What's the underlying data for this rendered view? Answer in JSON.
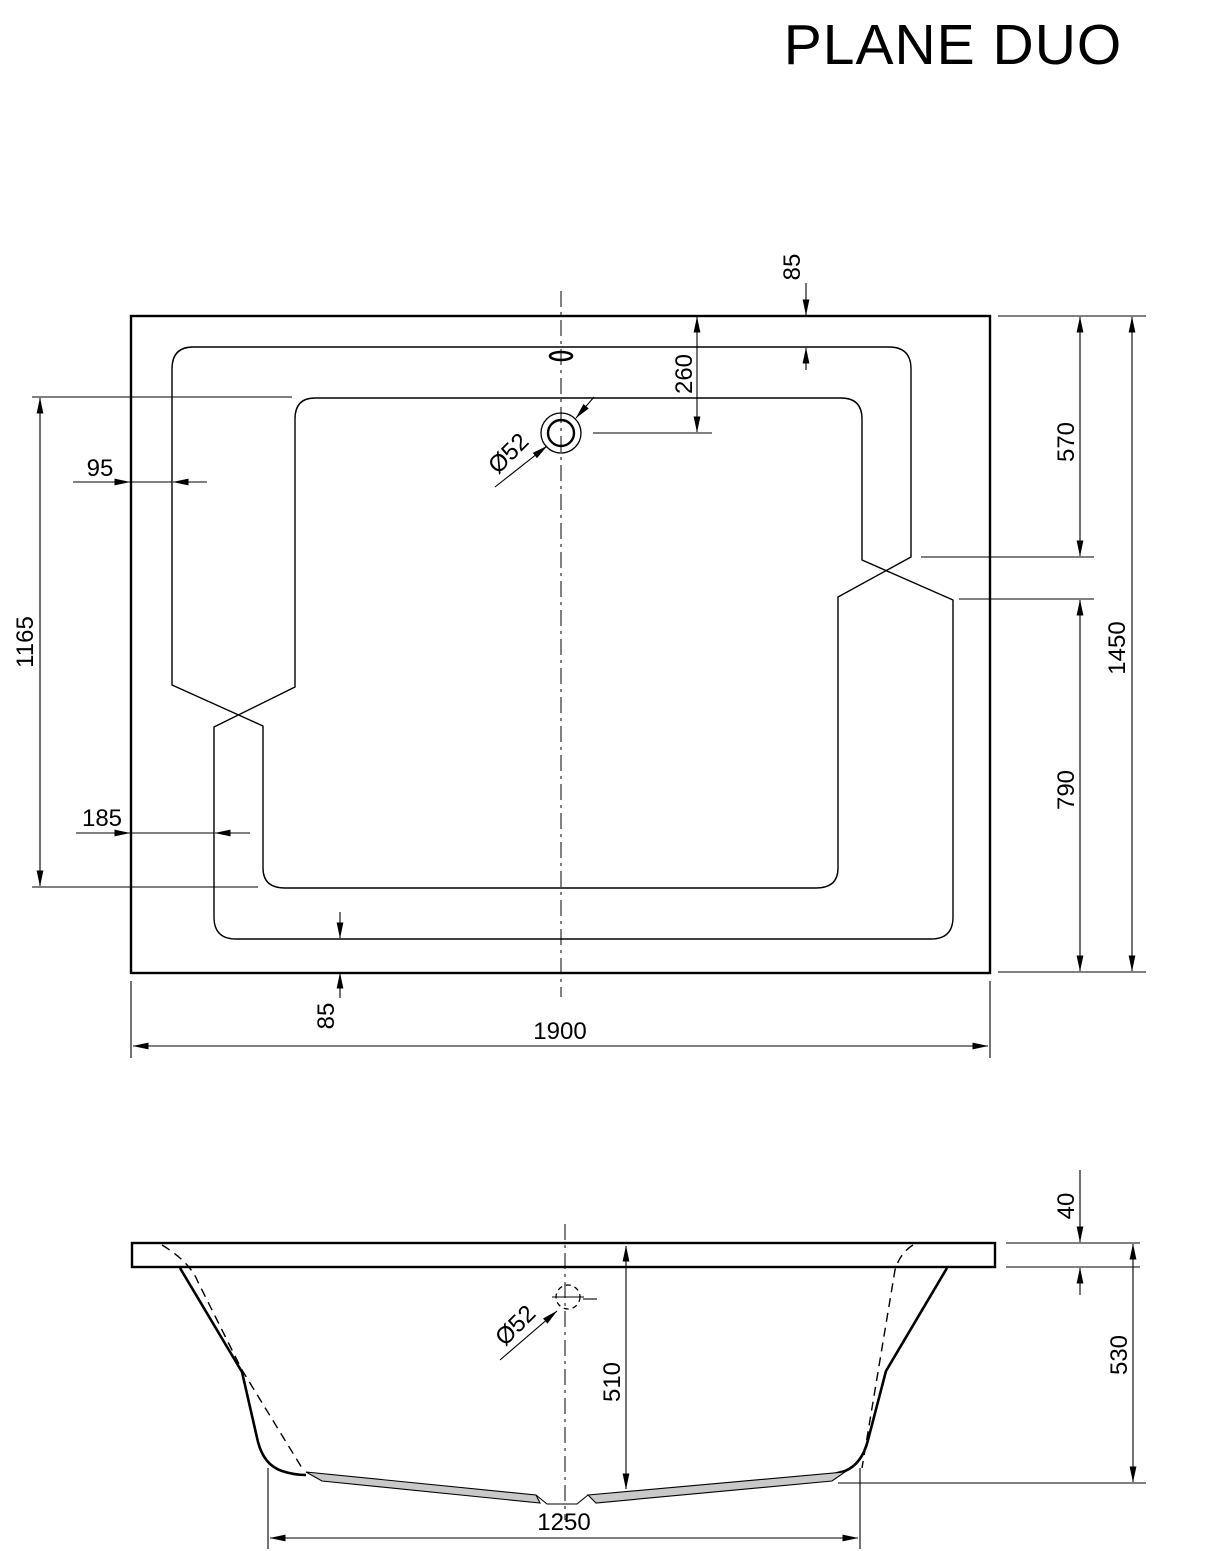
{
  "title": "PLANE DUO",
  "colors": {
    "line": "#000000",
    "background": "#ffffff",
    "floor_fill": "#c9c9c9"
  },
  "top_view": {
    "name": "bathtub plan view",
    "dims": {
      "overall_length": "1900",
      "overall_width": "1450",
      "rim_top": "85",
      "rim_bottom": "85",
      "rim_left_upper": "95",
      "rim_left_lower": "185",
      "floor_length": "1165",
      "drain_from_top_edge": "260",
      "right_upper_section": "570",
      "right_lower_section": "790",
      "drain_diameter": "Ø52"
    }
  },
  "side_view": {
    "name": "bathtub front elevation",
    "dims": {
      "rim_thickness": "40",
      "overall_height": "530",
      "inner_depth": "510",
      "base_length": "1250",
      "drain_diameter": "Ø52"
    }
  }
}
